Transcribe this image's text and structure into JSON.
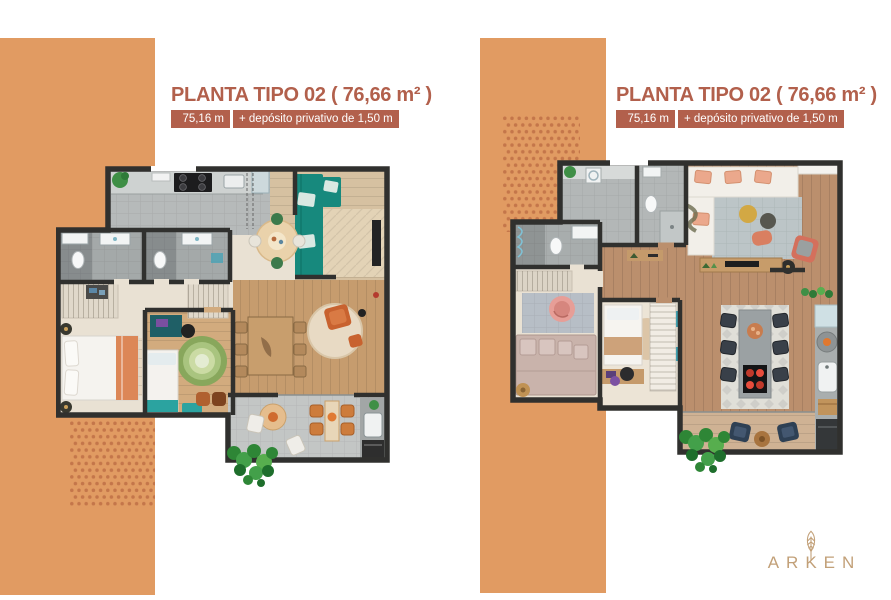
{
  "palette": {
    "accent": "#b2604c",
    "badge_text": "#ffffff",
    "band": "#e19b62",
    "band_dot": "#c4764a",
    "logo": "#c2a078",
    "wall": "#30302e"
  },
  "cards": [
    {
      "title": "PLANTA TIPO 02 ( 76,66 m² )",
      "badge_area": "75,16 m",
      "badge_deposit": "+ depósito privativo de 1,50 m"
    },
    {
      "title": "PLANTA TIPO 02 ( 76,66 m² )",
      "badge_area": "75,16 m",
      "badge_deposit": "+ depósito privativo de 1,50 m"
    }
  ],
  "logo": {
    "text": "ARKEN"
  }
}
